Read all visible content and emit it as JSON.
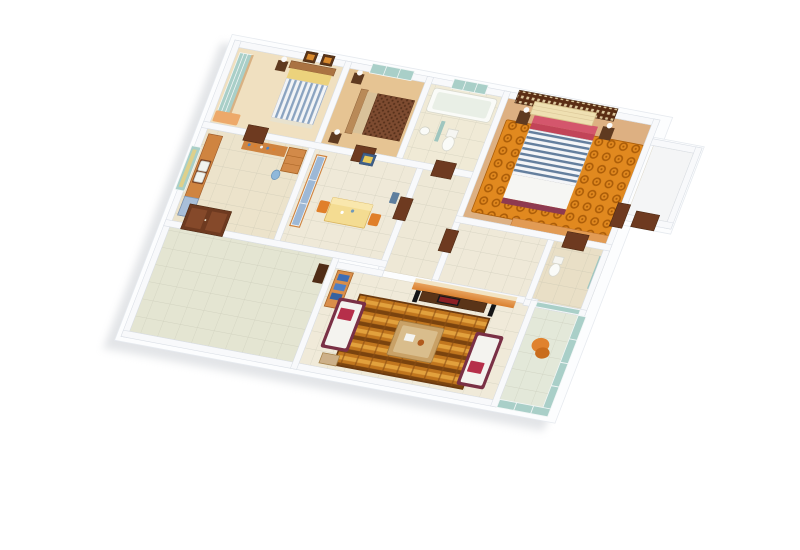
{
  "scene": {
    "type": "3d-floorplan-cutaway-render",
    "view": "isometric dollhouse view, rotated clockwise, white background",
    "background": "#ffffff",
    "visible_text": "none"
  },
  "palette": {
    "wall": "#f8f9fb",
    "slab": "#fcfdfe",
    "teal_glass": "#a9cfc8",
    "door_brown": "#6e3a20",
    "door_panel": "#8a4a28",
    "dark_wood": "#5f3a20",
    "wood_cabinet": "#cf8440",
    "orange_accent": "#e0822e",
    "bench_orange": "#eda96a",
    "rug_master_orange": "#e1891f",
    "rug_living_brown": "#c1761e",
    "rug_border": "#6b3a10",
    "maroon_sofa": "#7a3045",
    "cushion_white": "#f4f3ef",
    "pillow_red": "#b62f4a",
    "bed_pillow_red": "#d4566c",
    "headboard_cream": "#efe0b2",
    "yellow_pillow": "#ecd27c",
    "table_yellow": "#f4dc92",
    "chair_orange": "#e07f2a",
    "books_blue": "#3d6db5",
    "cabinet_glass_blue": "#9db8d6",
    "media_cream": "#f2e4c4",
    "tv_black": "#17171a",
    "lamp_white": "#fafafa",
    "tub_white": "#fafbf8",
    "speaker_black": "#141416",
    "water_jug_blue": "#8fb8da"
  },
  "rooms": [
    {
      "id": "bedroom-1",
      "label": "Bedroom 1 (top-left)",
      "floor_color": "#f0e0c0",
      "furniture": [
        "teal glass wardrobe",
        "bed with blue striped duvet and yellow pillows",
        "checkered headboard",
        "bedside table with lamp",
        "two framed wall pictures",
        "orange bench"
      ]
    },
    {
      "id": "bedroom-2",
      "label": "Bedroom 2",
      "floor_color": "#e6c493",
      "furniture": [
        "bed with brown speckled duvet",
        "headboard on west side",
        "two bedside tables with lamps",
        "teal window"
      ]
    },
    {
      "id": "bathroom-1",
      "label": "Bathroom (top)",
      "floor_color": "#f0ead6",
      "furniture": [
        "bathtub",
        "pedestal sink",
        "toilet",
        "teal window",
        "teal divider panel"
      ]
    },
    {
      "id": "master-bedroom",
      "label": "Master bedroom",
      "floor_color": "#ddb082",
      "furniture": [
        "dark lattice screen wall",
        "cream tufted headboard",
        "bed with red pillows and blue striped duvet",
        "two dark bedside tables with lamps",
        "orange swirl rug",
        "long orange dresser"
      ]
    },
    {
      "id": "closet-ne",
      "label": "Small room (top-right)",
      "floor_color": "#f4f5f6",
      "furniture": [
        "empty",
        "brown door"
      ]
    },
    {
      "id": "kitchen",
      "label": "Kitchen",
      "floor_color": "#ece3cb",
      "furniture": [
        "counter with double sink",
        "wall shelf with jars",
        "tall cabinet",
        "blue drawer unit",
        "water jug",
        "window with yellow curtain"
      ]
    },
    {
      "id": "dining",
      "label": "Dining room",
      "floor_color": "#efe9d8",
      "furniture": [
        "blue glass cabinet",
        "yellow dining table",
        "two orange chairs",
        "blue wall picture",
        "blue bin"
      ]
    },
    {
      "id": "corridor",
      "label": "Corridor",
      "floor_color": "#eee8d6",
      "furniture": [
        "brown doors"
      ]
    },
    {
      "id": "hall",
      "label": "Hall",
      "floor_color": "#efe9d8",
      "furniture": []
    },
    {
      "id": "bathroom-2",
      "label": "Bathroom (right)",
      "floor_color": "#e9dfc6",
      "furniture": [
        "toilet",
        "teal pane",
        "brown door"
      ]
    },
    {
      "id": "veranda",
      "label": "Entry veranda (bottom-left)",
      "floor_color": "#e4e5d2",
      "furniture": [
        "double wooden entry door",
        "dark cabinet",
        "tiled floor"
      ]
    },
    {
      "id": "living-room",
      "label": "Living room",
      "floor_color": "#f0ead9",
      "furniture": [
        "basket-weave orange rug",
        "two white sofas with maroon frames and red cushions",
        "wooden coffee table",
        "TV media wall with console and speakers",
        "bookshelf with blue books",
        "wooden stool"
      ]
    },
    {
      "id": "balcony",
      "label": "Balcony (bottom-right)",
      "floor_color": "#e3e8d9",
      "furniture": [
        "teal glass walls",
        "orange lounge chair"
      ]
    }
  ]
}
